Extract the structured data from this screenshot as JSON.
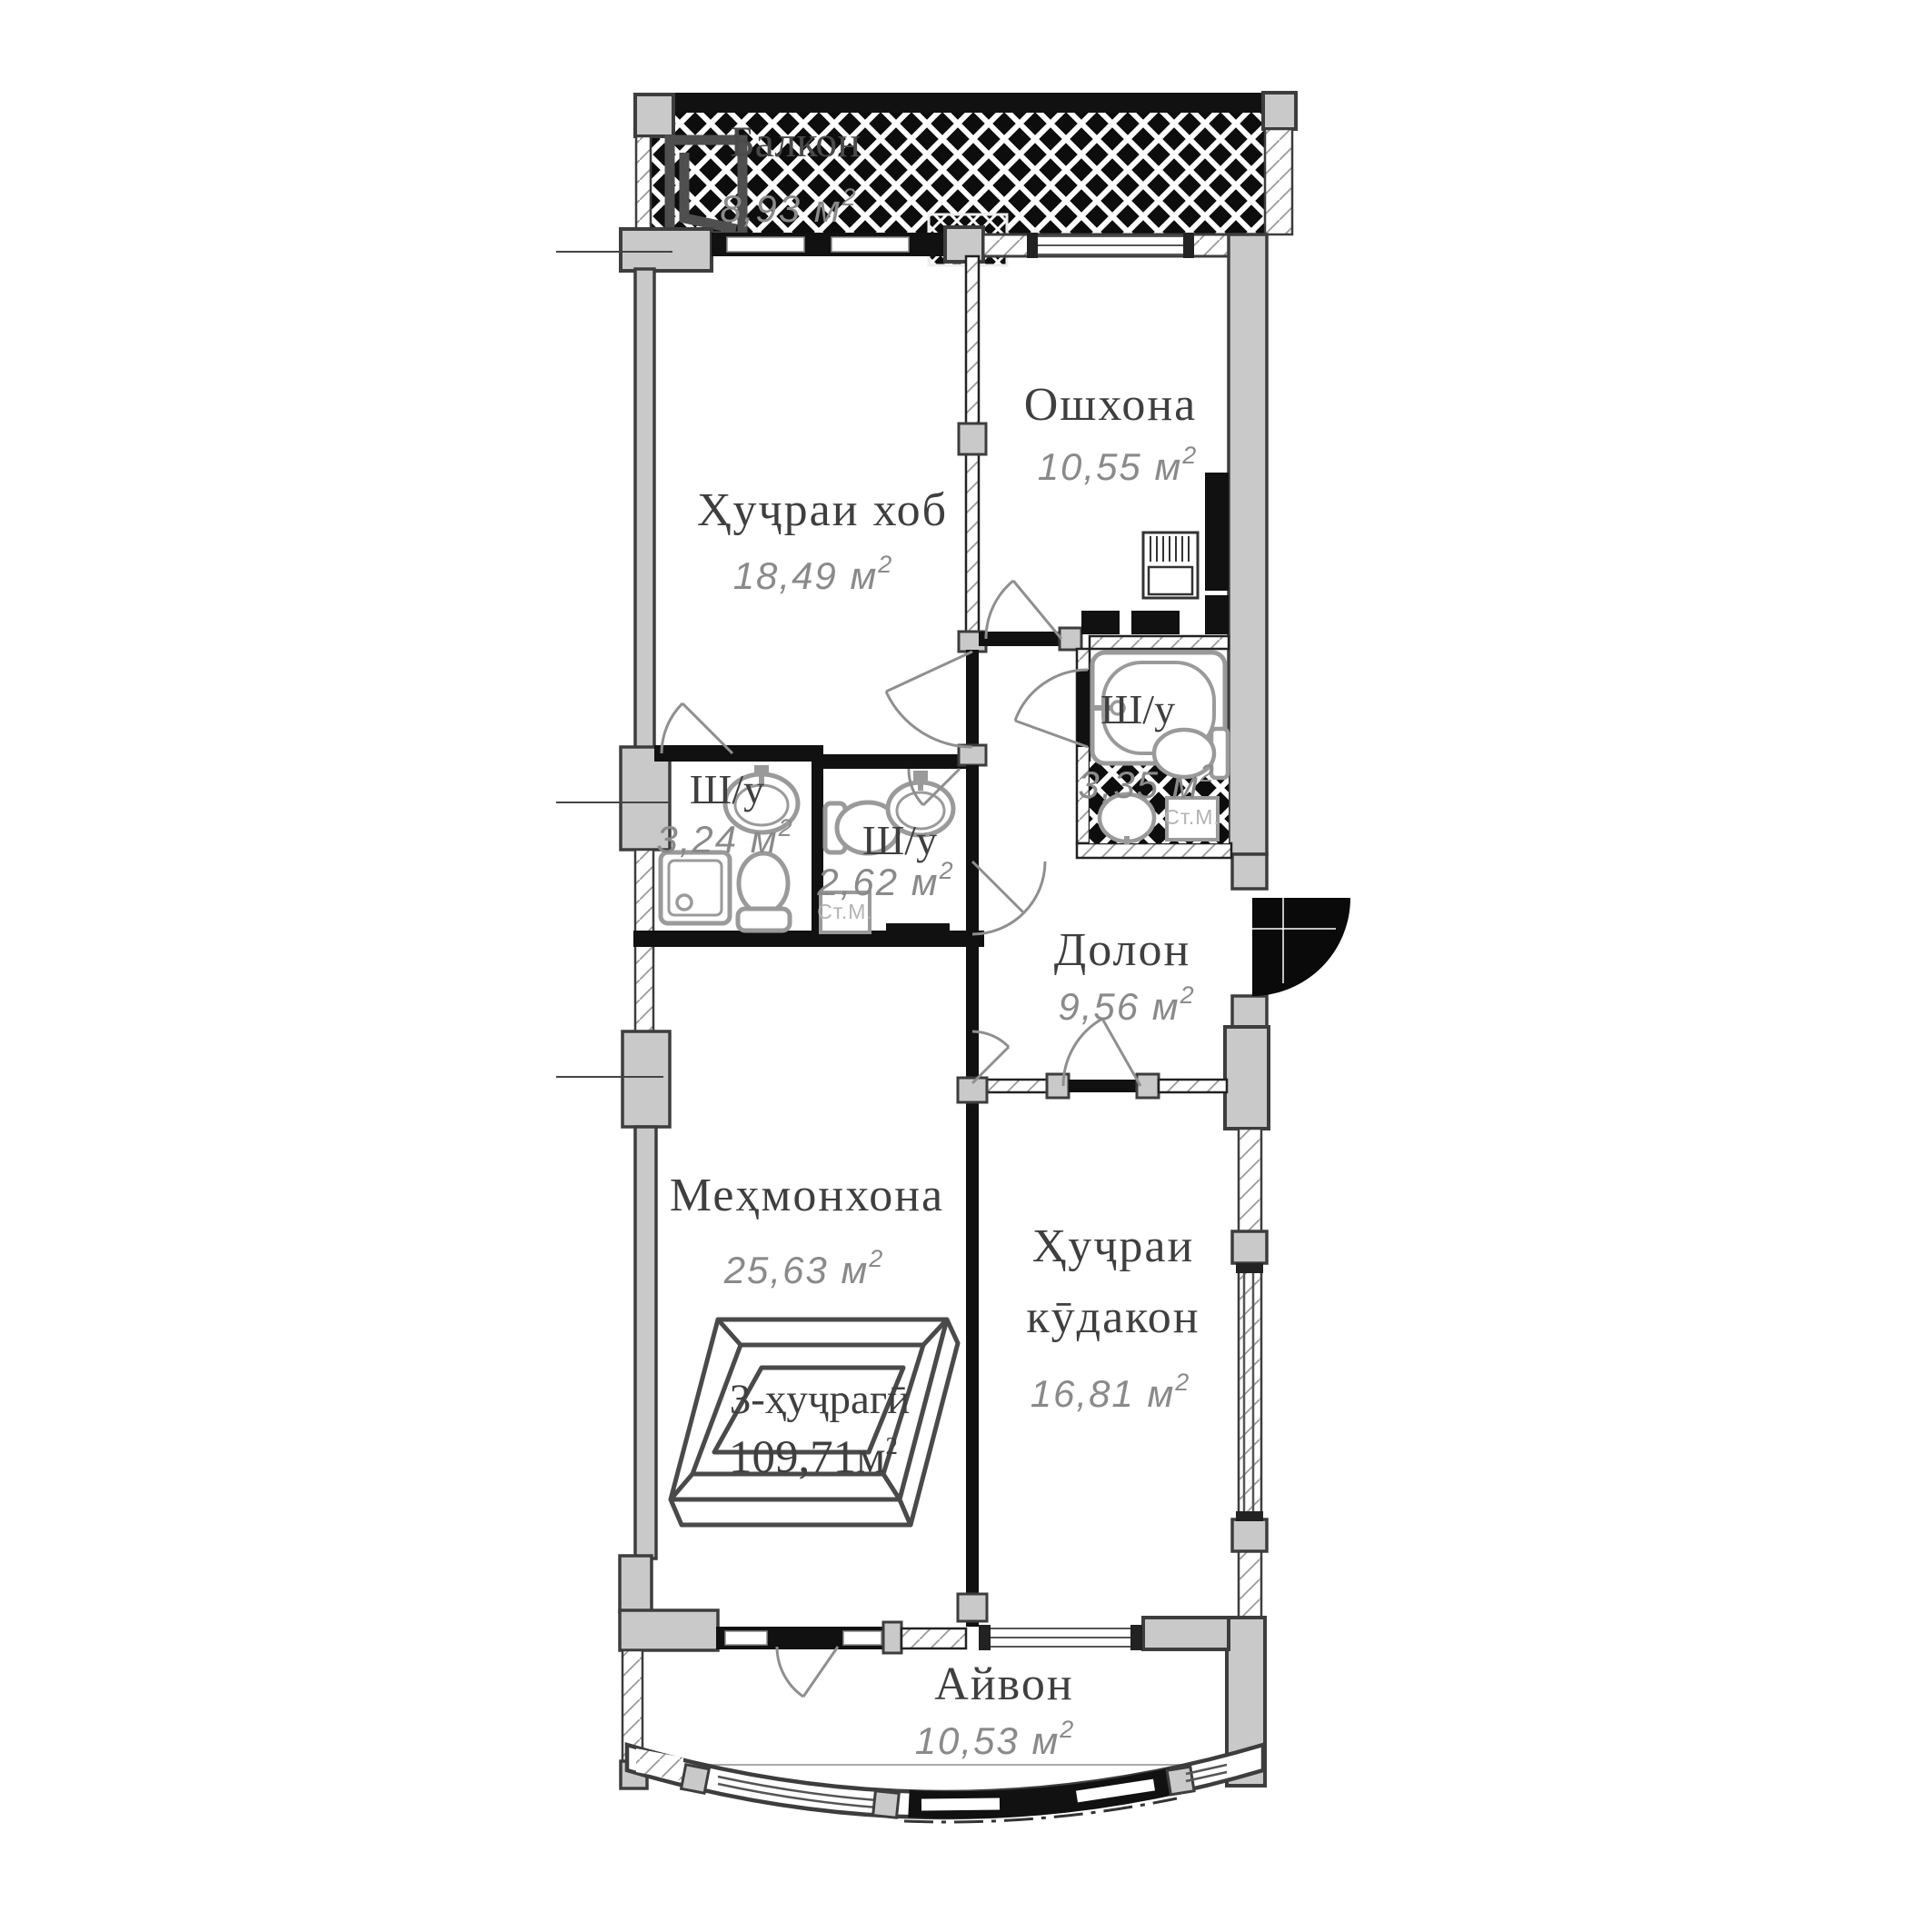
{
  "plan": {
    "type": "apartment-floor-plan",
    "stamp": {
      "line1": "3-ҳуҷрагӣ",
      "line2": "109,71м",
      "sup": "2"
    },
    "units": {
      "sup": "2"
    },
    "rooms": {
      "balcony": {
        "name": "Балкон",
        "area": "8,93 м"
      },
      "bedroom": {
        "name": "Ҳуҷраи хоб",
        "area": "18,49 м"
      },
      "kitchen": {
        "name": "Ошхона",
        "area": "10,55 м"
      },
      "bath_ensuite": {
        "name": "Ш/у",
        "area": "3,24 м"
      },
      "bath_guest": {
        "name": "Ш/у",
        "area": "2,62 м"
      },
      "bath_main": {
        "name": "Ш/у",
        "area": "3,35 м"
      },
      "hallway": {
        "name": "Долон",
        "area": "9,56 м"
      },
      "living_room": {
        "name": "Меҳмонхона",
        "area": "25,63 м"
      },
      "kids_room": {
        "name_line1": "Ҳуҷраи",
        "name_line2": "кӯдакон",
        "area": "16,81 м"
      },
      "veranda": {
        "name": "Айвон",
        "area": "10,53 м"
      }
    },
    "appliance_labels": {
      "washing_machine": "Ст.М."
    },
    "colors": {
      "wall_fill": "#c9c9c9",
      "wall_outline": "#3d3d3d",
      "partition": "#111111",
      "room_label": "#3f3f3f",
      "area_label": "#8a8a8a",
      "fixture_outline": "#9a9a9a"
    }
  }
}
